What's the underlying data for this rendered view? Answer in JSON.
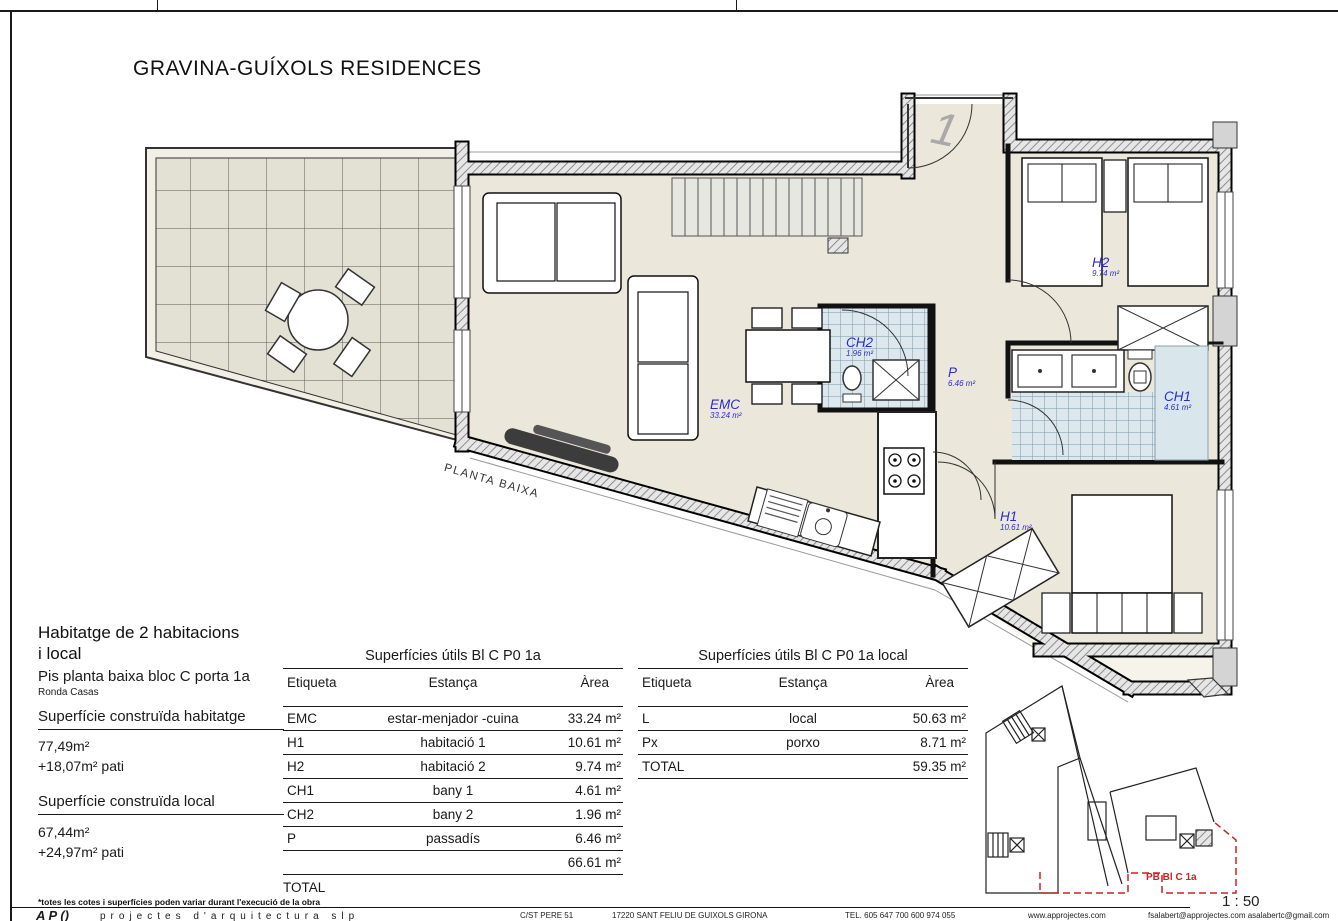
{
  "title": "GRAVINA-GUÍXOLS RESIDENCES",
  "plan": {
    "name_label": "PLANTA BAIXA",
    "entrance_number": "1",
    "rooms": [
      {
        "code": "EMC",
        "area": "33.24 m²"
      },
      {
        "code": "CH2",
        "area": "1.96 m²"
      },
      {
        "code": "P",
        "area": "6.46 m²"
      },
      {
        "code": "H2",
        "area": "9.74 m²"
      },
      {
        "code": "CH1",
        "area": "4.61 m²"
      },
      {
        "code": "H1",
        "area": "10.61 m²"
      }
    ]
  },
  "info": {
    "heading_line1": "Habitatge de 2 habitacions",
    "heading_line2": "i local",
    "subheading": "Pis planta baixa bloc C porta 1a",
    "street": "Ronda Casas",
    "built_dwelling_label": "Superfície construïda habitatge",
    "built_dwelling_value": "77,49m²",
    "built_dwelling_patio": "+18,07m² pati",
    "built_local_label": "Superfície construïda local",
    "built_local_value": "67,44m²",
    "built_local_patio": "+24,97m² pati"
  },
  "tables": {
    "dwelling": {
      "title": "Superfícies útils Bl C P0 1a",
      "headers": {
        "etiqueta": "Etiqueta",
        "estanca": "Estança",
        "area": "Àrea"
      },
      "rows": [
        {
          "label": "EMC",
          "room": "estar-menjador -cuina",
          "area": "33.24 m²"
        },
        {
          "label": "H1",
          "room": "habitació 1",
          "area": "10.61 m²"
        },
        {
          "label": "H2",
          "room": "habitació 2",
          "area": "9.74 m²"
        },
        {
          "label": "CH1",
          "room": "bany 1",
          "area": "4.61 m²"
        },
        {
          "label": "CH2",
          "room": "bany 2",
          "area": "1.96 m²"
        },
        {
          "label": "P",
          "room": "passadís",
          "area": "6.46 m²"
        }
      ],
      "subtotal": "66.61 m²",
      "total_label": "TOTAL"
    },
    "local": {
      "title": "Superfícies útils Bl C P0 1a local",
      "headers": {
        "etiqueta": "Etiqueta",
        "estanca": "Estança",
        "area": "Àrea"
      },
      "rows": [
        {
          "label": "L",
          "room": "local",
          "area": "50.63 m²"
        },
        {
          "label": "Px",
          "room": "porxo",
          "area": "8.71 m²"
        }
      ],
      "total_label": "TOTAL",
      "total_value": "59.35 m²"
    }
  },
  "site_plan": {
    "unit_label": "PB Bl C 1a"
  },
  "footer": {
    "note": "*totes les cotes i superfícies poden variar durant l'execució de la obra",
    "scale": "1 : 50",
    "logo": "A P ()",
    "firm": "projectes d'arquitectura slp",
    "address": "C/ST PERE 51",
    "city": "17220 SANT FELIU DE GUIXOLS GIRONA",
    "phone": "TEL. 605 647 700  600 974 055",
    "web": "www.approjectes.com",
    "email": "fsalabert@approjectes.com  asalabertc@gmail.com"
  },
  "colors": {
    "label_blue": "#2b2bd0",
    "highlight_red": "#cc2222",
    "floor_beige": "#ebe7da",
    "tile_blue": "#dce8ee"
  }
}
